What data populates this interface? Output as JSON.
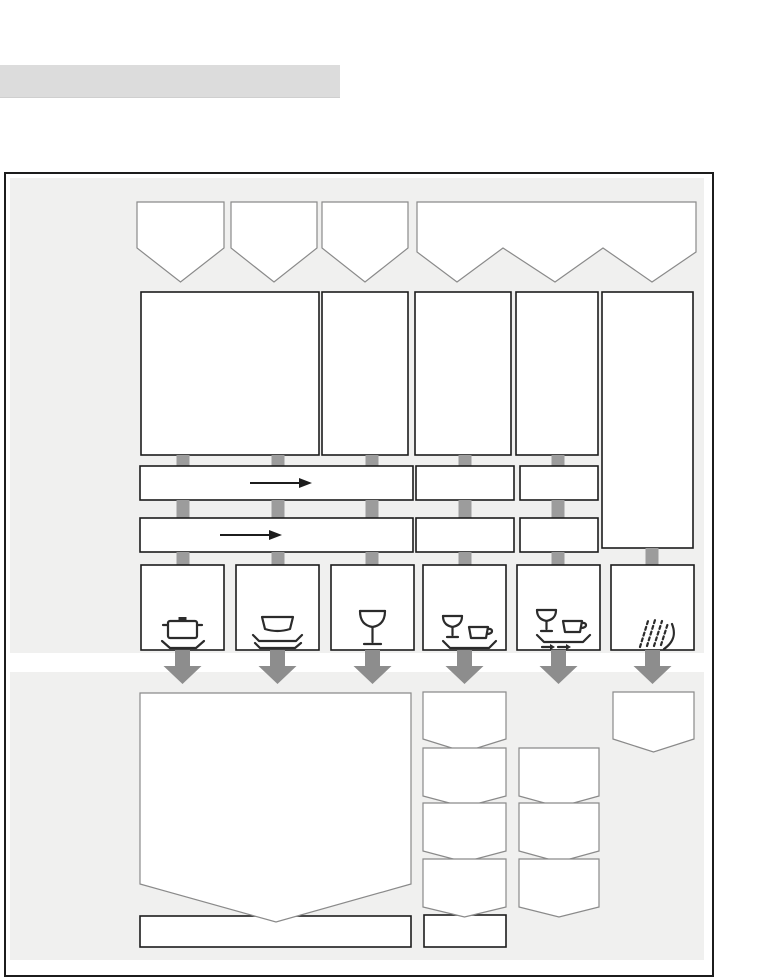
{
  "document": {
    "type": "appliance-manual programme overview diagram",
    "visible_text": ""
  },
  "title_bar": {
    "label": "",
    "color": "#dcdcdc"
  },
  "colors": {
    "page-bg": "#ffffff",
    "titlebar": "#dcdcdc",
    "zone": "#f0f0ef",
    "frame": "#1c1c1c",
    "thin": "#8a8a8a",
    "thick": "#1c1c1c",
    "fill": "#ffffff",
    "tab": "#9c9c9c",
    "bigarrow": "#8d8d8d",
    "icon": "#2b2b2b"
  },
  "diagram": {
    "top_banners": {
      "count": 4,
      "note_shape": "pennant banners pointing down, fourth banner has three points"
    },
    "column_count": 6,
    "stage_rows": {
      "row2_boxes": 5,
      "row3_boxes": 3,
      "row4_boxes": 3,
      "right_tall_box": 1
    },
    "flow_arrows_in_bars": 2,
    "connector_tabs": 16,
    "big_down_arrows": 6,
    "load_icons": [
      {
        "name": "pot-icon"
      },
      {
        "name": "plates-icon"
      },
      {
        "name": "wine-glass-icon"
      },
      {
        "name": "glass-and-cup-icon"
      },
      {
        "name": "glass-and-cup-transfer-icon"
      },
      {
        "name": "spray-jets-icon"
      }
    ],
    "lower_section": {
      "large_pointed_panel": 1,
      "pennant_stacks": {
        "column4": 4,
        "column5": 3,
        "column6": 1
      },
      "bottom_rectangles": 2
    }
  }
}
